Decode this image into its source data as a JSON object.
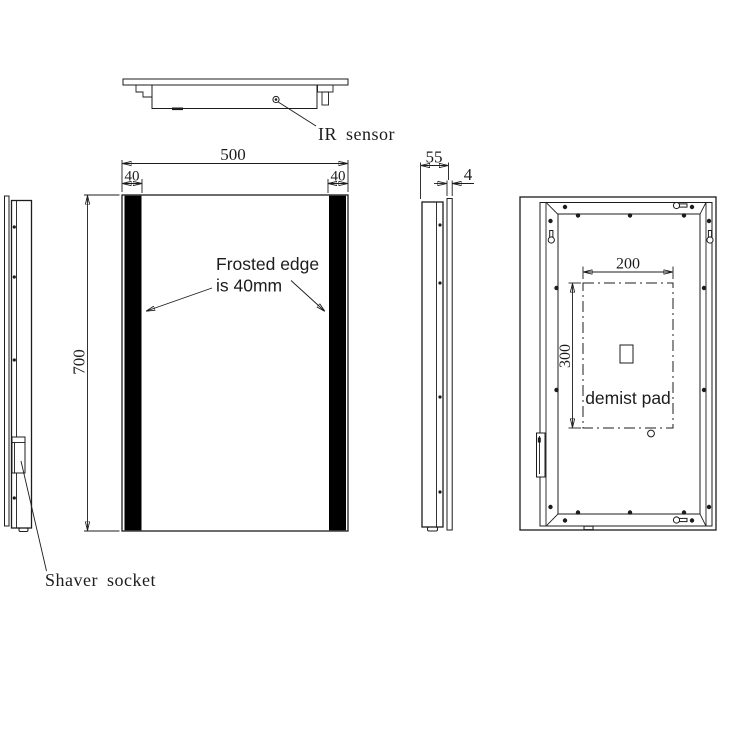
{
  "annotations": {
    "ir_sensor": "IR sensor",
    "shaver_socket": "Shaver socket",
    "frosted_edge_line1": "Frosted edge",
    "frosted_edge_line2": "is 40mm",
    "demist_pad": "demist pad"
  },
  "dimensions": {
    "front_width_mm": "500",
    "front_height_mm": "700",
    "frost_left_mm": "40",
    "frost_right_mm": "40",
    "depth_mm": "55",
    "glass_thickness_mm": "4",
    "pad_width_mm": "200",
    "pad_height_mm": "300"
  },
  "colors": {
    "line": "#1c1c1c",
    "background": "#ffffff",
    "frosted_strip_fill": "#000000"
  }
}
